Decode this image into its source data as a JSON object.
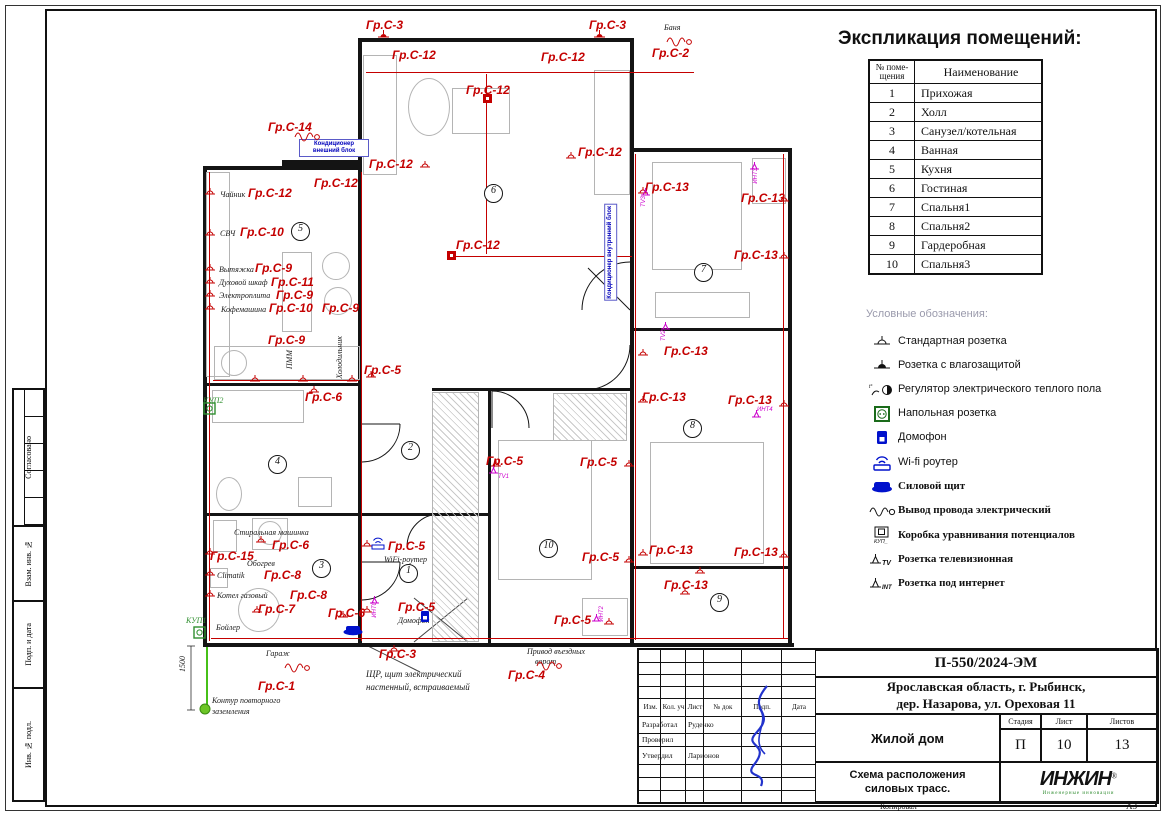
{
  "explication": {
    "title": "Экспликация помещений:",
    "col1": "№ поме- щения",
    "col2": "Наименование",
    "rows": [
      [
        "1",
        "Прихожая"
      ],
      [
        "2",
        "Холл"
      ],
      [
        "3",
        "Санузел/котельная"
      ],
      [
        "4",
        "Ванная"
      ],
      [
        "5",
        "Кухня"
      ],
      [
        "6",
        "Гостиная"
      ],
      [
        "7",
        "Спальня1"
      ],
      [
        "8",
        "Спальня2"
      ],
      [
        "9",
        "Гардеробная"
      ],
      [
        "10",
        "Спальня3"
      ]
    ]
  },
  "legend": {
    "title": "Условные обозначения:",
    "items": [
      {
        "icon": "socket-standard",
        "label": "Стандартная розетка"
      },
      {
        "icon": "socket-moisture",
        "label": "Розетка с влагозащитой"
      },
      {
        "icon": "heating-regulator",
        "label": "Регулятор электрического теплого пола"
      },
      {
        "icon": "floor-socket",
        "label": "Напольная розетка"
      },
      {
        "icon": "intercom",
        "label": "Домофон"
      },
      {
        "icon": "wifi-router",
        "label": "Wi-fi роутер"
      },
      {
        "icon": "power-shield",
        "label": "Силовой щит",
        "serif": true
      },
      {
        "icon": "wire-outlet",
        "label": "Вывод провода электрический",
        "serif": true
      },
      {
        "icon": "kup-box",
        "label": "Коробка уравнивания потенциалов",
        "serif": true
      },
      {
        "icon": "tv-socket",
        "label": "Розетка телевизионная",
        "serif": true
      },
      {
        "icon": "int-socket",
        "label": "Розетка под интернет",
        "serif": true
      }
    ]
  },
  "titleblock": {
    "doc_number": "П-550/2024-ЭМ",
    "address_line1": "Ярославская область, г. Рыбинск,",
    "address_line2": "дер. Назарова, ул. Ореховая 11",
    "object_name": "Жилой дом",
    "sheet_title_line1": "Схема расположения",
    "sheet_title_line2": "силовых трасс.",
    "stage_label": "Стадия",
    "stage": "П",
    "sheet_label": "Лист",
    "sheet": "10",
    "sheets_label": "Листов",
    "sheets": "13",
    "header_cells": [
      "Изм.",
      "Кол. уч",
      "Лист",
      "№ док",
      "Подп.",
      "Дата"
    ],
    "roles": [
      {
        "role": "Разработал",
        "name": "Руденко"
      },
      {
        "role": "Проверил",
        "name": ""
      },
      {
        "role": "Утвердил",
        "name": "Ларионов"
      }
    ],
    "logo": "ИНЖИН",
    "logo_reg": "®",
    "logo_sub": "Инженерные инновации",
    "copied_label": "Копировал",
    "format_label": "А3"
  },
  "side_labels": [
    {
      "label": "Согласовано",
      "h": 137,
      "grid": true
    },
    {
      "label": "Взам. инв. №",
      "h": 75
    },
    {
      "label": "Подп. и дата",
      "h": 87
    },
    {
      "label": "Инв. № подл.",
      "h": 111
    }
  ],
  "plan": {
    "rooms": [
      {
        "n": "5",
        "x": 291,
        "y": 222
      },
      {
        "n": "6",
        "x": 484,
        "y": 184
      },
      {
        "n": "7",
        "x": 694,
        "y": 263
      },
      {
        "n": "8",
        "x": 683,
        "y": 419
      },
      {
        "n": "2",
        "x": 401,
        "y": 441
      },
      {
        "n": "4",
        "x": 268,
        "y": 455
      },
      {
        "n": "3",
        "x": 312,
        "y": 559
      },
      {
        "n": "1",
        "x": 399,
        "y": 564
      },
      {
        "n": "10",
        "x": 539,
        "y": 539
      },
      {
        "n": "9",
        "x": 710,
        "y": 593
      }
    ],
    "labels": [
      {
        "t": "Гр.С-3",
        "x": 366,
        "y": 19,
        "c": "r"
      },
      {
        "t": "Гр.С-12",
        "x": 392,
        "y": 49,
        "c": "r"
      },
      {
        "t": "Гр.С-3",
        "x": 589,
        "y": 19,
        "c": "r"
      },
      {
        "t": "Гр.С-12",
        "x": 541,
        "y": 51,
        "c": "r"
      },
      {
        "t": "Баня",
        "x": 664,
        "y": 24,
        "c": "b"
      },
      {
        "t": "Гр.С-2",
        "x": 652,
        "y": 47,
        "c": "r"
      },
      {
        "t": "Гр.С-12",
        "x": 466,
        "y": 84,
        "c": "r"
      },
      {
        "t": "Гр.С-14",
        "x": 268,
        "y": 121,
        "c": "r"
      },
      {
        "t": "Кондиционер внешний блок",
        "x": 299,
        "y": 139,
        "c": "bl",
        "wd": 64
      },
      {
        "t": "Гр.С-12",
        "x": 369,
        "y": 158,
        "c": "r"
      },
      {
        "t": "Гр.С-12",
        "x": 578,
        "y": 146,
        "c": "r"
      },
      {
        "t": "Гр.С-12",
        "x": 314,
        "y": 177,
        "c": "r"
      },
      {
        "t": "Чайник",
        "x": 220,
        "y": 191,
        "c": "b"
      },
      {
        "t": "Гр.С-12",
        "x": 248,
        "y": 187,
        "c": "r"
      },
      {
        "t": "СВЧ",
        "x": 220,
        "y": 230,
        "c": "b"
      },
      {
        "t": "Гр.С-10",
        "x": 240,
        "y": 226,
        "c": "r"
      },
      {
        "t": "Вытяжка",
        "x": 219,
        "y": 266,
        "c": "b"
      },
      {
        "t": "Гр.С-9",
        "x": 255,
        "y": 262,
        "c": "r"
      },
      {
        "t": "Духовой шкаф",
        "x": 219,
        "y": 279,
        "c": "b"
      },
      {
        "t": "Гр.С-11",
        "x": 271,
        "y": 276,
        "c": "r"
      },
      {
        "t": "Электроплита",
        "x": 219,
        "y": 292,
        "c": "b"
      },
      {
        "t": "Гр.С-9",
        "x": 276,
        "y": 289,
        "c": "r"
      },
      {
        "t": "Кофемашина",
        "x": 221,
        "y": 306,
        "c": "b"
      },
      {
        "t": "Гр.С-10",
        "x": 269,
        "y": 302,
        "c": "r"
      },
      {
        "t": "Гр.С-9",
        "x": 322,
        "y": 302,
        "c": "r"
      },
      {
        "t": "Гр.С-9",
        "x": 268,
        "y": 334,
        "c": "r"
      },
      {
        "t": "ПММ",
        "x": 286,
        "y": 350,
        "c": "b",
        "v": 1
      },
      {
        "t": "Холодильник",
        "x": 336,
        "y": 336,
        "c": "b",
        "v": 1
      },
      {
        "t": "Гр.С-5",
        "x": 364,
        "y": 364,
        "c": "r"
      },
      {
        "t": "КУП2",
        "x": 203,
        "y": 397,
        "c": "g"
      },
      {
        "t": "Гр.С-6",
        "x": 305,
        "y": 391,
        "c": "r"
      },
      {
        "t": "Кондиционер внутренний блок",
        "x": 604,
        "y": 204,
        "c": "bl",
        "v": 1
      },
      {
        "t": "Гр.С-13",
        "x": 645,
        "y": 181,
        "c": "r"
      },
      {
        "t": "TV3",
        "x": 641,
        "y": 196,
        "c": "m",
        "v": 1
      },
      {
        "t": "ИНТ3",
        "x": 753,
        "y": 168,
        "c": "m",
        "v": 1
      },
      {
        "t": "Гр.С-13",
        "x": 741,
        "y": 192,
        "c": "r"
      },
      {
        "t": "Гр.С-13",
        "x": 734,
        "y": 249,
        "c": "r"
      },
      {
        "t": "Гр.С-12",
        "x": 456,
        "y": 239,
        "c": "r"
      },
      {
        "t": "TV2",
        "x": 661,
        "y": 330,
        "c": "m",
        "v": 1
      },
      {
        "t": "Гр.С-13",
        "x": 664,
        "y": 345,
        "c": "r"
      },
      {
        "t": "Гр.С-13",
        "x": 642,
        "y": 391,
        "c": "r"
      },
      {
        "t": "Гр.С-13",
        "x": 728,
        "y": 394,
        "c": "r"
      },
      {
        "t": "ИНТ4",
        "x": 757,
        "y": 407,
        "c": "m"
      },
      {
        "t": "Гр.С-5",
        "x": 486,
        "y": 455,
        "c": "r"
      },
      {
        "t": "TV1",
        "x": 498,
        "y": 474,
        "c": "m"
      },
      {
        "t": "Гр.С-5",
        "x": 580,
        "y": 456,
        "c": "r"
      },
      {
        "t": "Гр.С-5",
        "x": 582,
        "y": 551,
        "c": "r"
      },
      {
        "t": "Гр.С-13",
        "x": 649,
        "y": 544,
        "c": "r"
      },
      {
        "t": "Гр.С-13",
        "x": 734,
        "y": 546,
        "c": "r"
      },
      {
        "t": "Гр.С-13",
        "x": 664,
        "y": 579,
        "c": "r"
      },
      {
        "t": "Гр.С-5",
        "x": 554,
        "y": 614,
        "c": "r"
      },
      {
        "t": "ИНТ2",
        "x": 599,
        "y": 606,
        "c": "m",
        "v": 1
      },
      {
        "t": "Стиральная машинка",
        "x": 234,
        "y": 529,
        "c": "b"
      },
      {
        "t": "Гр.С-6",
        "x": 272,
        "y": 539,
        "c": "r"
      },
      {
        "t": "Гр.С-15",
        "x": 210,
        "y": 550,
        "c": "r"
      },
      {
        "t": "Обогрев",
        "x": 247,
        "y": 560,
        "c": "b"
      },
      {
        "t": "Climatik",
        "x": 217,
        "y": 572,
        "c": "b"
      },
      {
        "t": "Гр.С-8",
        "x": 264,
        "y": 569,
        "c": "r"
      },
      {
        "t": "Котел газовый",
        "x": 217,
        "y": 592,
        "c": "b"
      },
      {
        "t": "Гр.С-8",
        "x": 290,
        "y": 589,
        "c": "r"
      },
      {
        "t": "Гр.С-7",
        "x": 258,
        "y": 603,
        "c": "r"
      },
      {
        "t": "Бойлер",
        "x": 216,
        "y": 624,
        "c": "b"
      },
      {
        "t": "КУП1",
        "x": 186,
        "y": 617,
        "c": "g"
      },
      {
        "t": "Гр.С-6",
        "x": 328,
        "y": 607,
        "c": "r"
      },
      {
        "t": "Гр.С-5",
        "x": 388,
        "y": 540,
        "c": "r"
      },
      {
        "t": "WiFi-роутер",
        "x": 384,
        "y": 556,
        "c": "b"
      },
      {
        "t": "Гр.С-5",
        "x": 398,
        "y": 601,
        "c": "r"
      },
      {
        "t": "Домофон",
        "x": 398,
        "y": 617,
        "c": "b"
      },
      {
        "t": "ИНТ0",
        "x": 372,
        "y": 602,
        "c": "m",
        "v": 1
      },
      {
        "t": "Гр.С-3",
        "x": 379,
        "y": 648,
        "c": "r"
      },
      {
        "t": "ЩР, щит электрический",
        "x": 366,
        "y": 670,
        "c": "b2"
      },
      {
        "t": "настенный, встраиваемый",
        "x": 366,
        "y": 683,
        "c": "b2"
      },
      {
        "t": "Гараж",
        "x": 266,
        "y": 650,
        "c": "b"
      },
      {
        "t": "Гр.С-1",
        "x": 258,
        "y": 680,
        "c": "r"
      },
      {
        "t": "Привод въездных",
        "x": 527,
        "y": 648,
        "c": "b"
      },
      {
        "t": "ворот",
        "x": 535,
        "y": 658,
        "c": "b"
      },
      {
        "t": "Гр.С-4",
        "x": 508,
        "y": 669,
        "c": "r"
      },
      {
        "t": "Контур повторного",
        "x": 212,
        "y": 697,
        "c": "b"
      },
      {
        "t": "заземления",
        "x": 212,
        "y": 708,
        "c": "b"
      },
      {
        "t": "1500",
        "x": 179,
        "y": 656,
        "c": "b",
        "v": 1
      }
    ],
    "markers": [
      {
        "k": "ws",
        "x": 378,
        "y": 30
      },
      {
        "k": "ws",
        "x": 594,
        "y": 30
      },
      {
        "k": "sock",
        "x": 420,
        "y": 161
      },
      {
        "k": "sock",
        "x": 566,
        "y": 152
      },
      {
        "k": "fs",
        "x": 482,
        "y": 93
      },
      {
        "k": "fs",
        "x": 446,
        "y": 250
      },
      {
        "k": "ww",
        "x": 666,
        "y": 34
      },
      {
        "k": "ww",
        "x": 294,
        "y": 129
      },
      {
        "k": "ww",
        "x": 284,
        "y": 660
      },
      {
        "k": "ww",
        "x": 536,
        "y": 658
      },
      {
        "k": "sock",
        "x": 205,
        "y": 188
      },
      {
        "k": "sock",
        "x": 205,
        "y": 229
      },
      {
        "k": "sock",
        "x": 205,
        "y": 264
      },
      {
        "k": "sock",
        "x": 205,
        "y": 277
      },
      {
        "k": "sock",
        "x": 205,
        "y": 290
      },
      {
        "k": "sock",
        "x": 205,
        "y": 303
      },
      {
        "k": "sock",
        "x": 250,
        "y": 375
      },
      {
        "k": "sock",
        "x": 298,
        "y": 375
      },
      {
        "k": "sock",
        "x": 347,
        "y": 375
      },
      {
        "k": "sock",
        "x": 366,
        "y": 371
      },
      {
        "k": "sock",
        "x": 309,
        "y": 386
      },
      {
        "k": "sock",
        "x": 638,
        "y": 187
      },
      {
        "k": "sock",
        "x": 779,
        "y": 195
      },
      {
        "k": "sock",
        "x": 779,
        "y": 252
      },
      {
        "k": "sock",
        "x": 638,
        "y": 349
      },
      {
        "k": "sock",
        "x": 638,
        "y": 396
      },
      {
        "k": "sock",
        "x": 779,
        "y": 400
      },
      {
        "k": "sock",
        "x": 491,
        "y": 460
      },
      {
        "k": "sock",
        "x": 624,
        "y": 460
      },
      {
        "k": "sock",
        "x": 624,
        "y": 556
      },
      {
        "k": "sock",
        "x": 638,
        "y": 549
      },
      {
        "k": "sock",
        "x": 695,
        "y": 567
      },
      {
        "k": "sock",
        "x": 779,
        "y": 551
      },
      {
        "k": "sock",
        "x": 256,
        "y": 536
      },
      {
        "k": "sock",
        "x": 205,
        "y": 548
      },
      {
        "k": "sock",
        "x": 205,
        "y": 569
      },
      {
        "k": "sock",
        "x": 205,
        "y": 590
      },
      {
        "k": "sock",
        "x": 252,
        "y": 606
      },
      {
        "k": "sock",
        "x": 338,
        "y": 611
      },
      {
        "k": "sock",
        "x": 362,
        "y": 540
      },
      {
        "k": "sock",
        "x": 362,
        "y": 606
      },
      {
        "k": "sock",
        "x": 389,
        "y": 645
      },
      {
        "k": "sock",
        "x": 604,
        "y": 618
      },
      {
        "k": "sock",
        "x": 680,
        "y": 588
      },
      {
        "k": "tvm",
        "x": 641,
        "y": 188
      },
      {
        "k": "tvm",
        "x": 661,
        "y": 322
      },
      {
        "k": "tvm",
        "x": 489,
        "y": 466
      },
      {
        "k": "tvm",
        "x": 592,
        "y": 614
      },
      {
        "k": "tvm",
        "x": 370,
        "y": 596
      },
      {
        "k": "tvm",
        "x": 750,
        "y": 162
      },
      {
        "k": "tvm",
        "x": 752,
        "y": 410
      },
      {
        "k": "wifi",
        "x": 370,
        "y": 536
      },
      {
        "k": "dom",
        "x": 420,
        "y": 610
      },
      {
        "k": "shield",
        "x": 342,
        "y": 624
      },
      {
        "k": "kup",
        "x": 203,
        "y": 402
      },
      {
        "k": "kup",
        "x": 193,
        "y": 626
      },
      {
        "k": "gnd",
        "x": 199,
        "y": 703
      }
    ]
  }
}
